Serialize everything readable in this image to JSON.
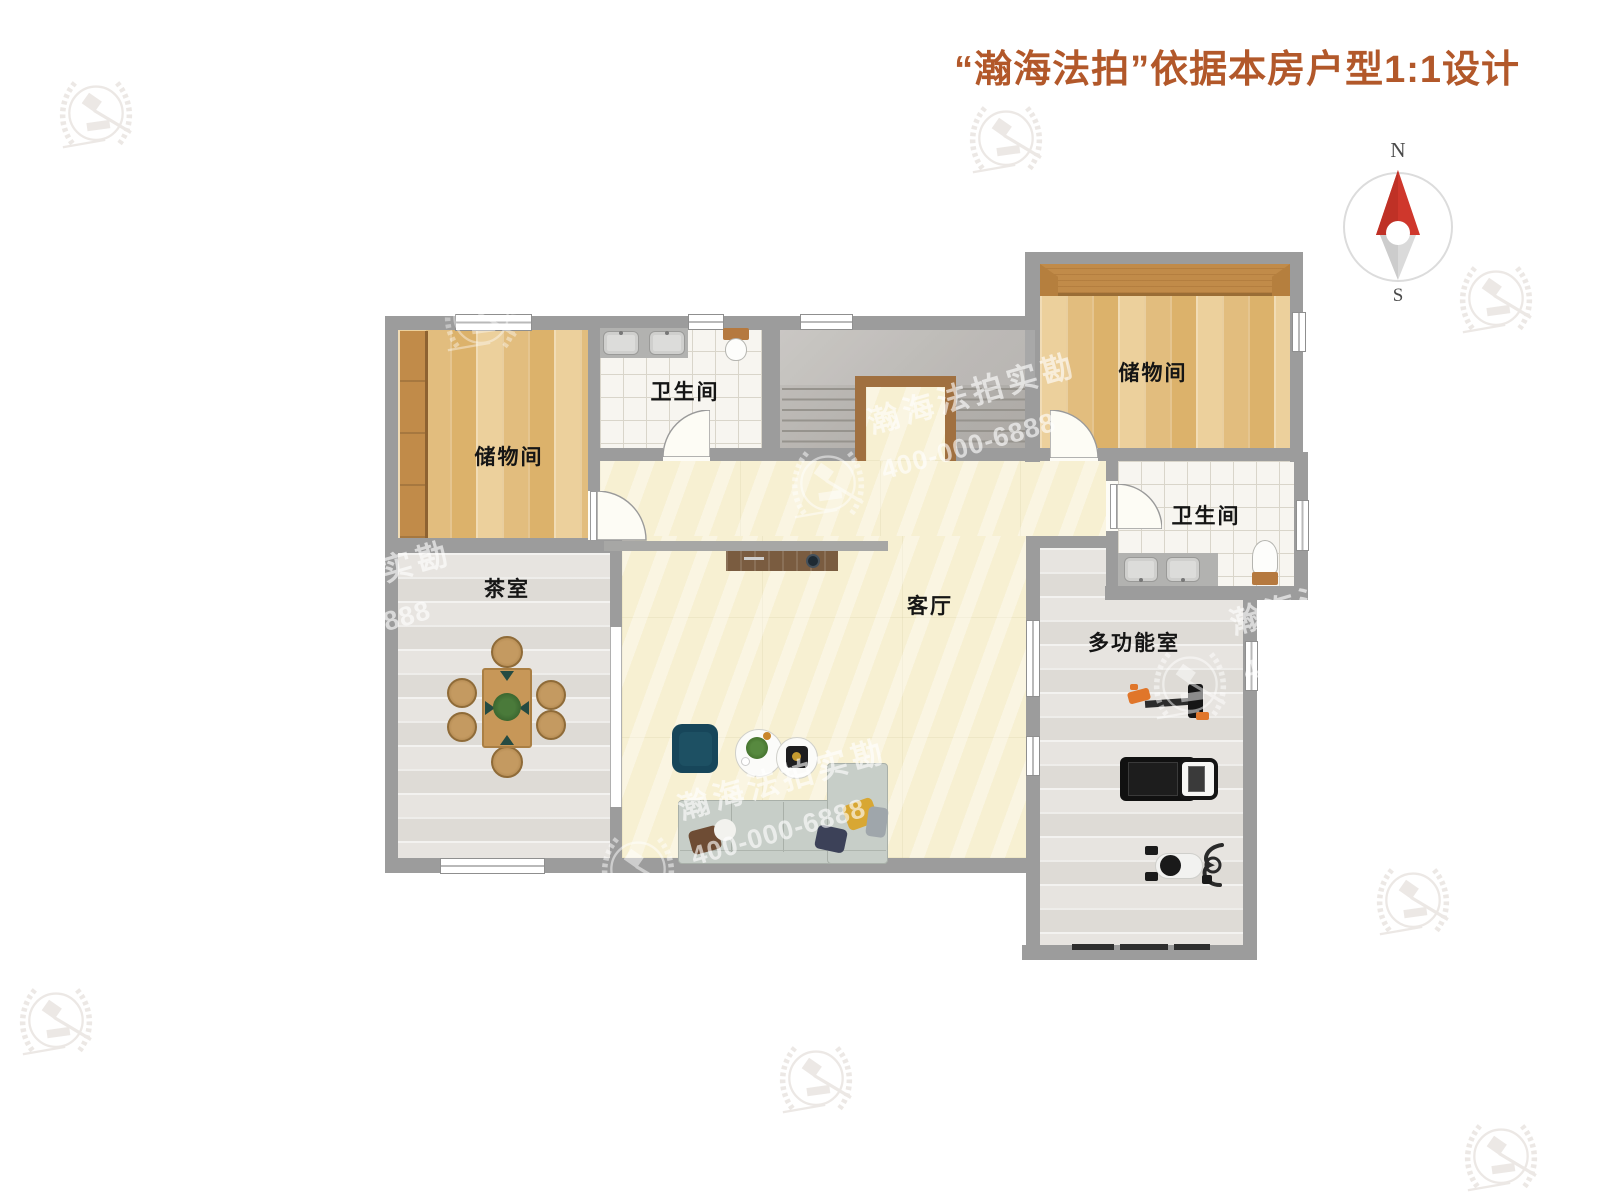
{
  "header": {
    "title": "“瀚海法拍”依据本房户型1:1设计"
  },
  "compass": {
    "north": "N",
    "south": "S"
  },
  "rooms": {
    "storage_left": {
      "label": "储物间"
    },
    "bath_top": {
      "label": "卫生间"
    },
    "storage_right": {
      "label": "储物间"
    },
    "bath_right": {
      "label": "卫生间"
    },
    "tea_room": {
      "label": "茶室"
    },
    "living_room": {
      "label": "客厅"
    },
    "multi_room": {
      "label": "多功能室"
    }
  },
  "watermark": {
    "brand": "瀚海法拍实勘",
    "phone": "400-000-6888"
  },
  "colors": {
    "title_accent": "#b2582a",
    "compass_red": "#cf372c",
    "wall": "#9c9c9c",
    "wood": "#e7c488",
    "cream_floor": "#f7f0d2"
  }
}
